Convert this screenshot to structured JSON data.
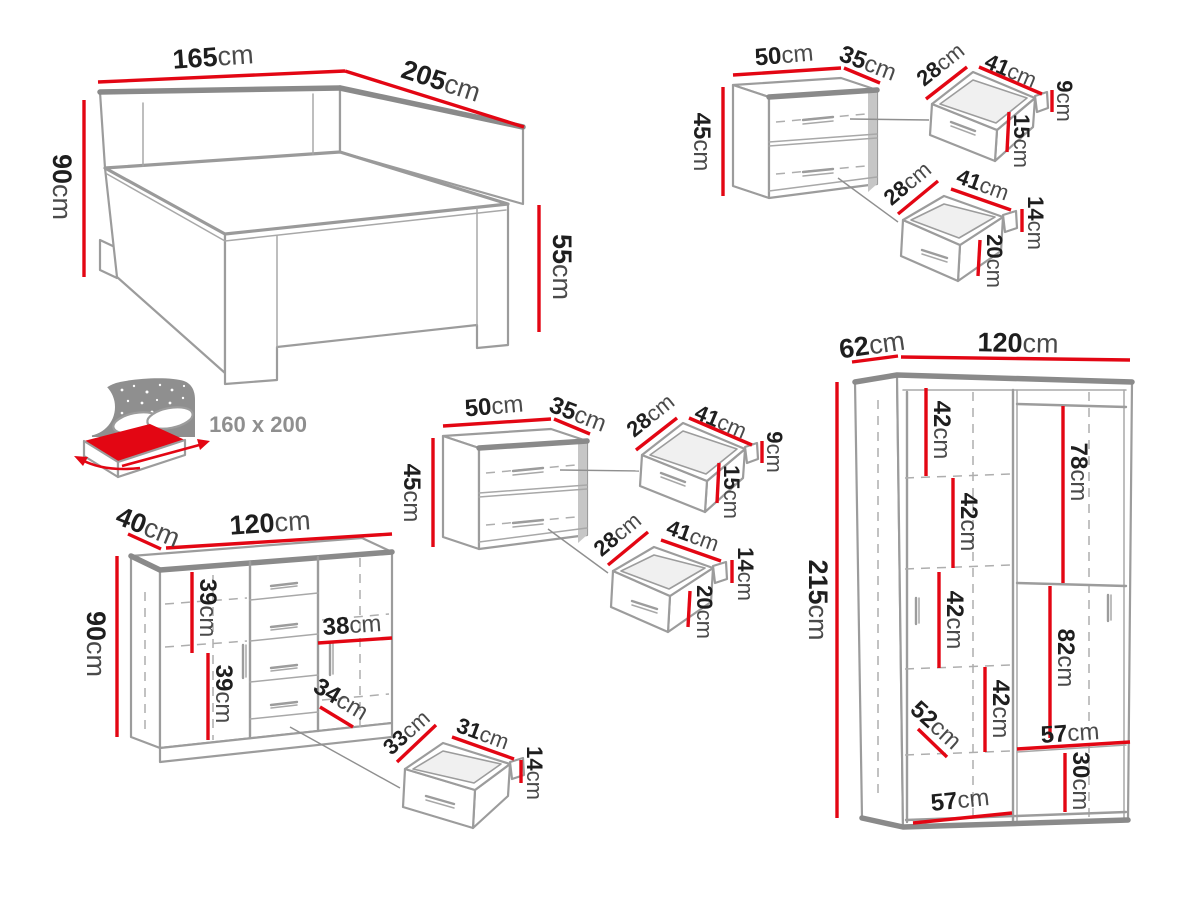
{
  "units": {
    "cm": "cm"
  },
  "colors": {
    "dimension_red": "#e30613",
    "outline_gray": "#9c9c9c",
    "accent_gray": "#8a8a8a",
    "number_dark": "#1e1e1e",
    "unit_gray": "#4a4a4a"
  },
  "bed": {
    "width": "165",
    "length": "205",
    "height": "90",
    "foot_height": "55",
    "mattress_size": "160 x 200"
  },
  "nightstand": {
    "width": "50",
    "depth": "35",
    "height": "45",
    "top_drawer": {
      "depth": "28",
      "width": "41",
      "back_height": "9",
      "front_height": "15"
    },
    "bottom_drawer": {
      "depth": "28",
      "width": "41",
      "back_height": "14",
      "front_height": "20"
    }
  },
  "chest": {
    "depth": "40",
    "width": "120",
    "height": "90",
    "door_inner_1": "39",
    "shelf_width": "38",
    "door_inner_2": "39",
    "drawer_opening": "34",
    "drawer": {
      "depth": "33",
      "width": "31",
      "height": "14"
    }
  },
  "wardrobe": {
    "depth": "62",
    "width": "120",
    "height": "215",
    "shelf_gap_1": "42",
    "shelf_gap_2": "42",
    "shelf_gap_3": "42",
    "shelf_gap_4": "42",
    "hanging_top": "78",
    "hanging_bottom": "82",
    "inner_diag": "52",
    "right_shelf_width": "57",
    "bottom_gap": "30",
    "bottom_width": "57"
  }
}
